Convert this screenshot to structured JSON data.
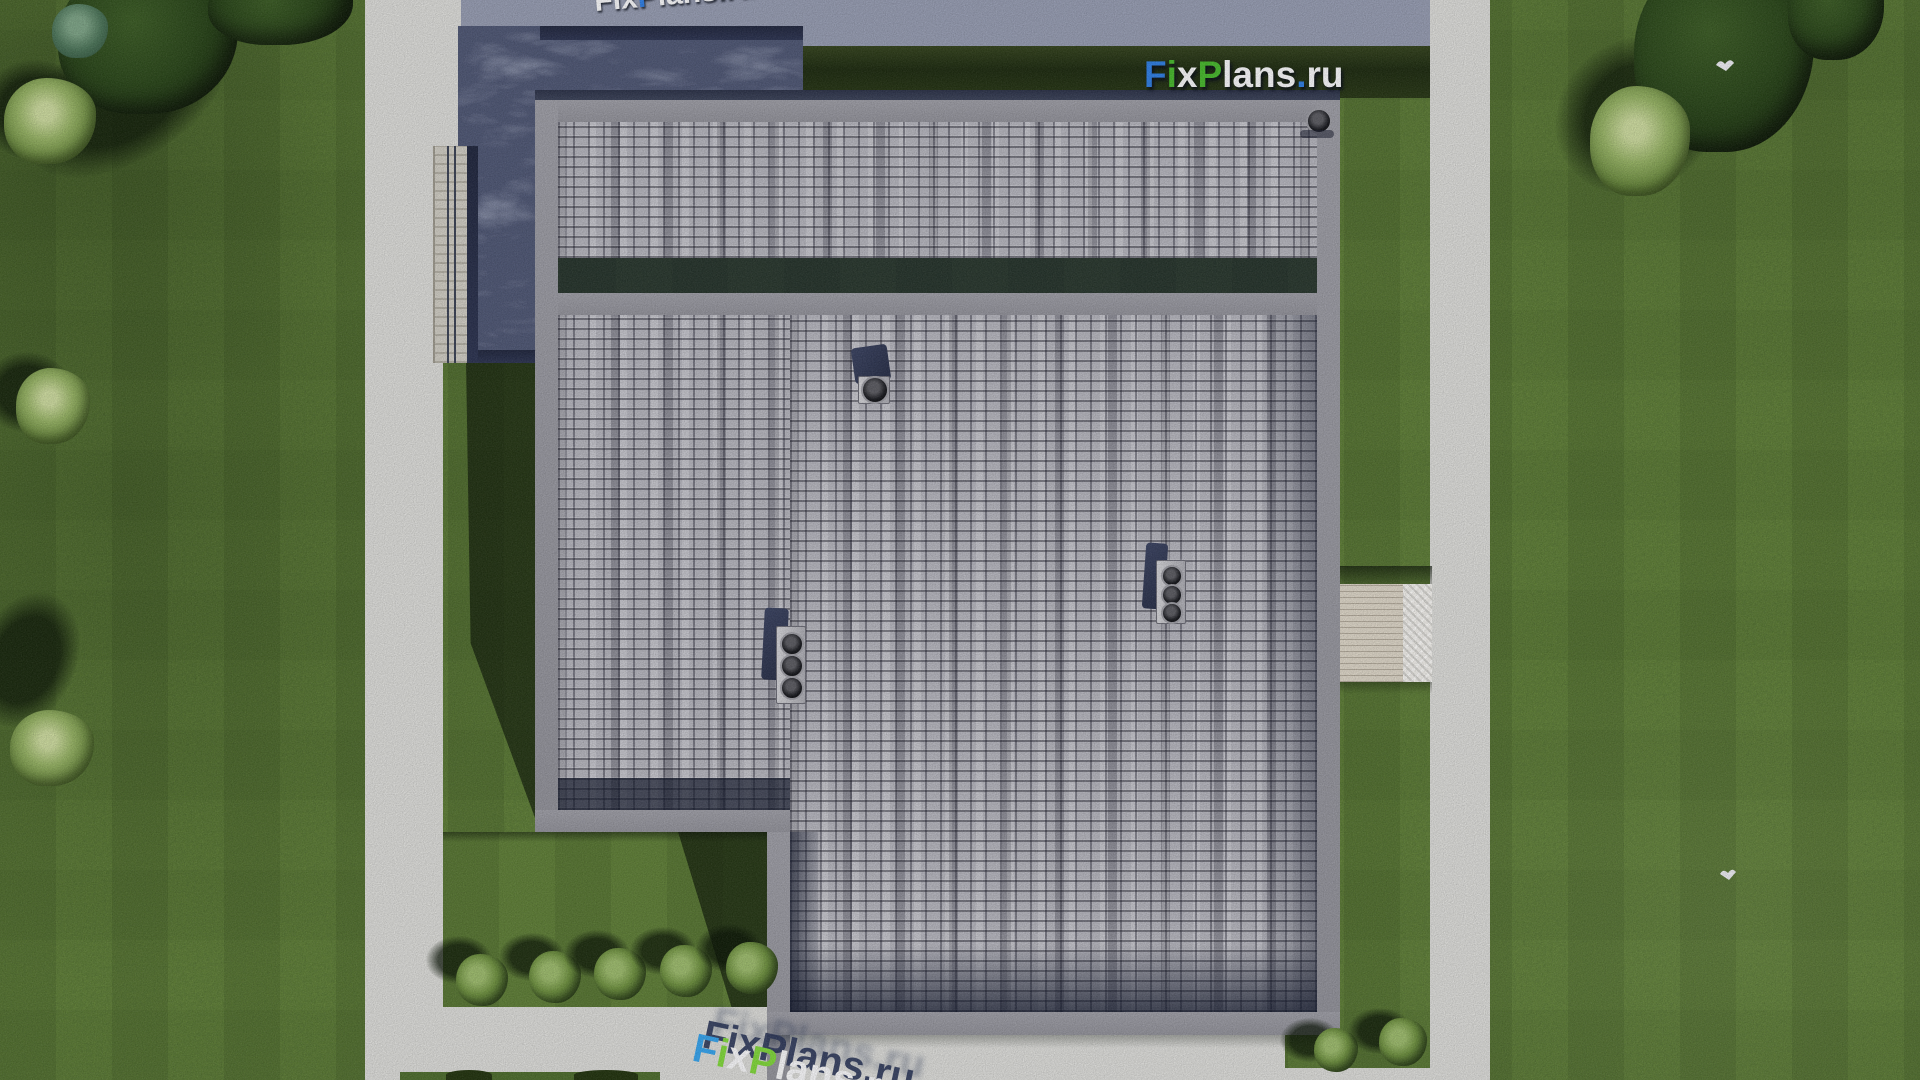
{
  "scene": {
    "type": "aerial top-down 3D architectural render",
    "site": "rectangular lawn plot bordered by light concrete walkways on the left, right and bottom, and a gray road strip along the top",
    "building": "house roof with gray staggered asphalt shingles framed by smooth gray parapets; upper roof section separated by a parapet band; dark flat membrane roof over the garage wing at top-left; bottom-left corner of the roof is notched around a lawn pocket",
    "roof_equipment": "three chimney/vent stacks with round caps on the main roof and one corner vent at the top-right parapet corner",
    "east_feature": "small wooden deck walkway with gravel strip connecting the house to the right path",
    "vegetation": "tree clusters in the top-left and top-right corners, two pale shrubs along the left edge, five trimmed round bushes in the south lawn pocket, two bushes near the bottom-right path corner",
    "birds_visible": 2
  },
  "watermark": {
    "text": "FixPlans.ru",
    "seg_f": "F",
    "seg_i": "i",
    "seg_x": "x",
    "seg_p": "P",
    "seg_lans": "lans",
    "seg_dot": ".",
    "seg_ru": "ru",
    "color_blue": "#2e7ce0",
    "color_green": "#46b52c",
    "color_white": "#f4f4f6",
    "instances": [
      "full logo on dark grass strip, top center-right",
      "clipped sliver of rotated logo at the very top edge",
      "large rotated logo, partially cut off, on the bottom walkway"
    ]
  },
  "palette": {
    "lawn_green": "#5f7e37",
    "lawn_shadow": "#16250d",
    "concrete_path": "#d8d8d5",
    "north_road": "#9399ae",
    "shingle_gray": "#b2b2ba",
    "parapet_gray": "#96969e",
    "flat_roof": "#4d5572",
    "flat_roof_edge": "#242b44",
    "deck_wood": "#d8d1c3",
    "deck_gravel": "#eceae6",
    "tree_dark": "#1c3210",
    "bush_green": "#6d8f3f"
  }
}
